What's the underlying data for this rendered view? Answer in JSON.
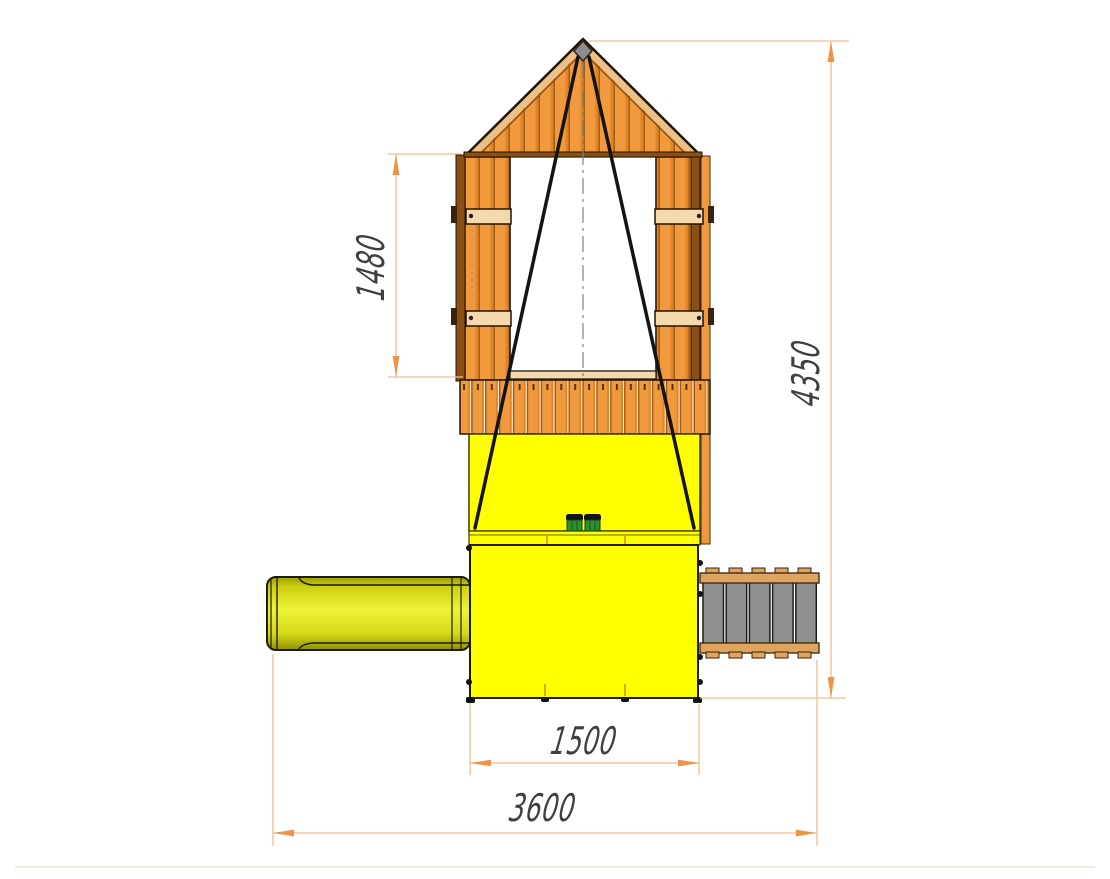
{
  "figure": {
    "type": "technical-elevation-drawing",
    "subject": "playground tower with slide and climbing ramp, side view with dimensions"
  },
  "dimensions": {
    "window_section_height": {
      "value": "1480",
      "orientation": "vertical",
      "measures": "gable wall opening height"
    },
    "overall_height": {
      "value": "4350",
      "orientation": "vertical",
      "measures": "ground to roof apex"
    },
    "tower_base_width": {
      "value": "1500",
      "orientation": "horizontal",
      "measures": "lower cabin width"
    },
    "overall_width": {
      "value": "3600",
      "orientation": "horizontal",
      "measures": "slide end to ramp end"
    }
  },
  "components": [
    "gable-roof",
    "apex-finial",
    "side-wall-panels",
    "window-opening",
    "shutter-cross-boards",
    "swing-ropes",
    "center-line",
    "balcony-railing",
    "upper-yellow-wall",
    "platform-edge",
    "lower-cabin",
    "grab-handles",
    "slide",
    "climbing-ramp"
  ],
  "colors": {
    "wood_orange": "#f09a3d",
    "wood_dark": "#8a4f14",
    "board_tan": "#f5d9ae",
    "panel_yellow": "#ffff00",
    "slide_yellow": "#e3e41c",
    "ramp_gray": "#8f8f8f",
    "rail_wood_tan": "#dfa45f",
    "rope_black": "#141414",
    "handle_green": "#2e8f30",
    "dimension_line": "#f2bc8e",
    "dimension_arrow": "#ee9448",
    "dimension_text": "#3f3f3f"
  }
}
